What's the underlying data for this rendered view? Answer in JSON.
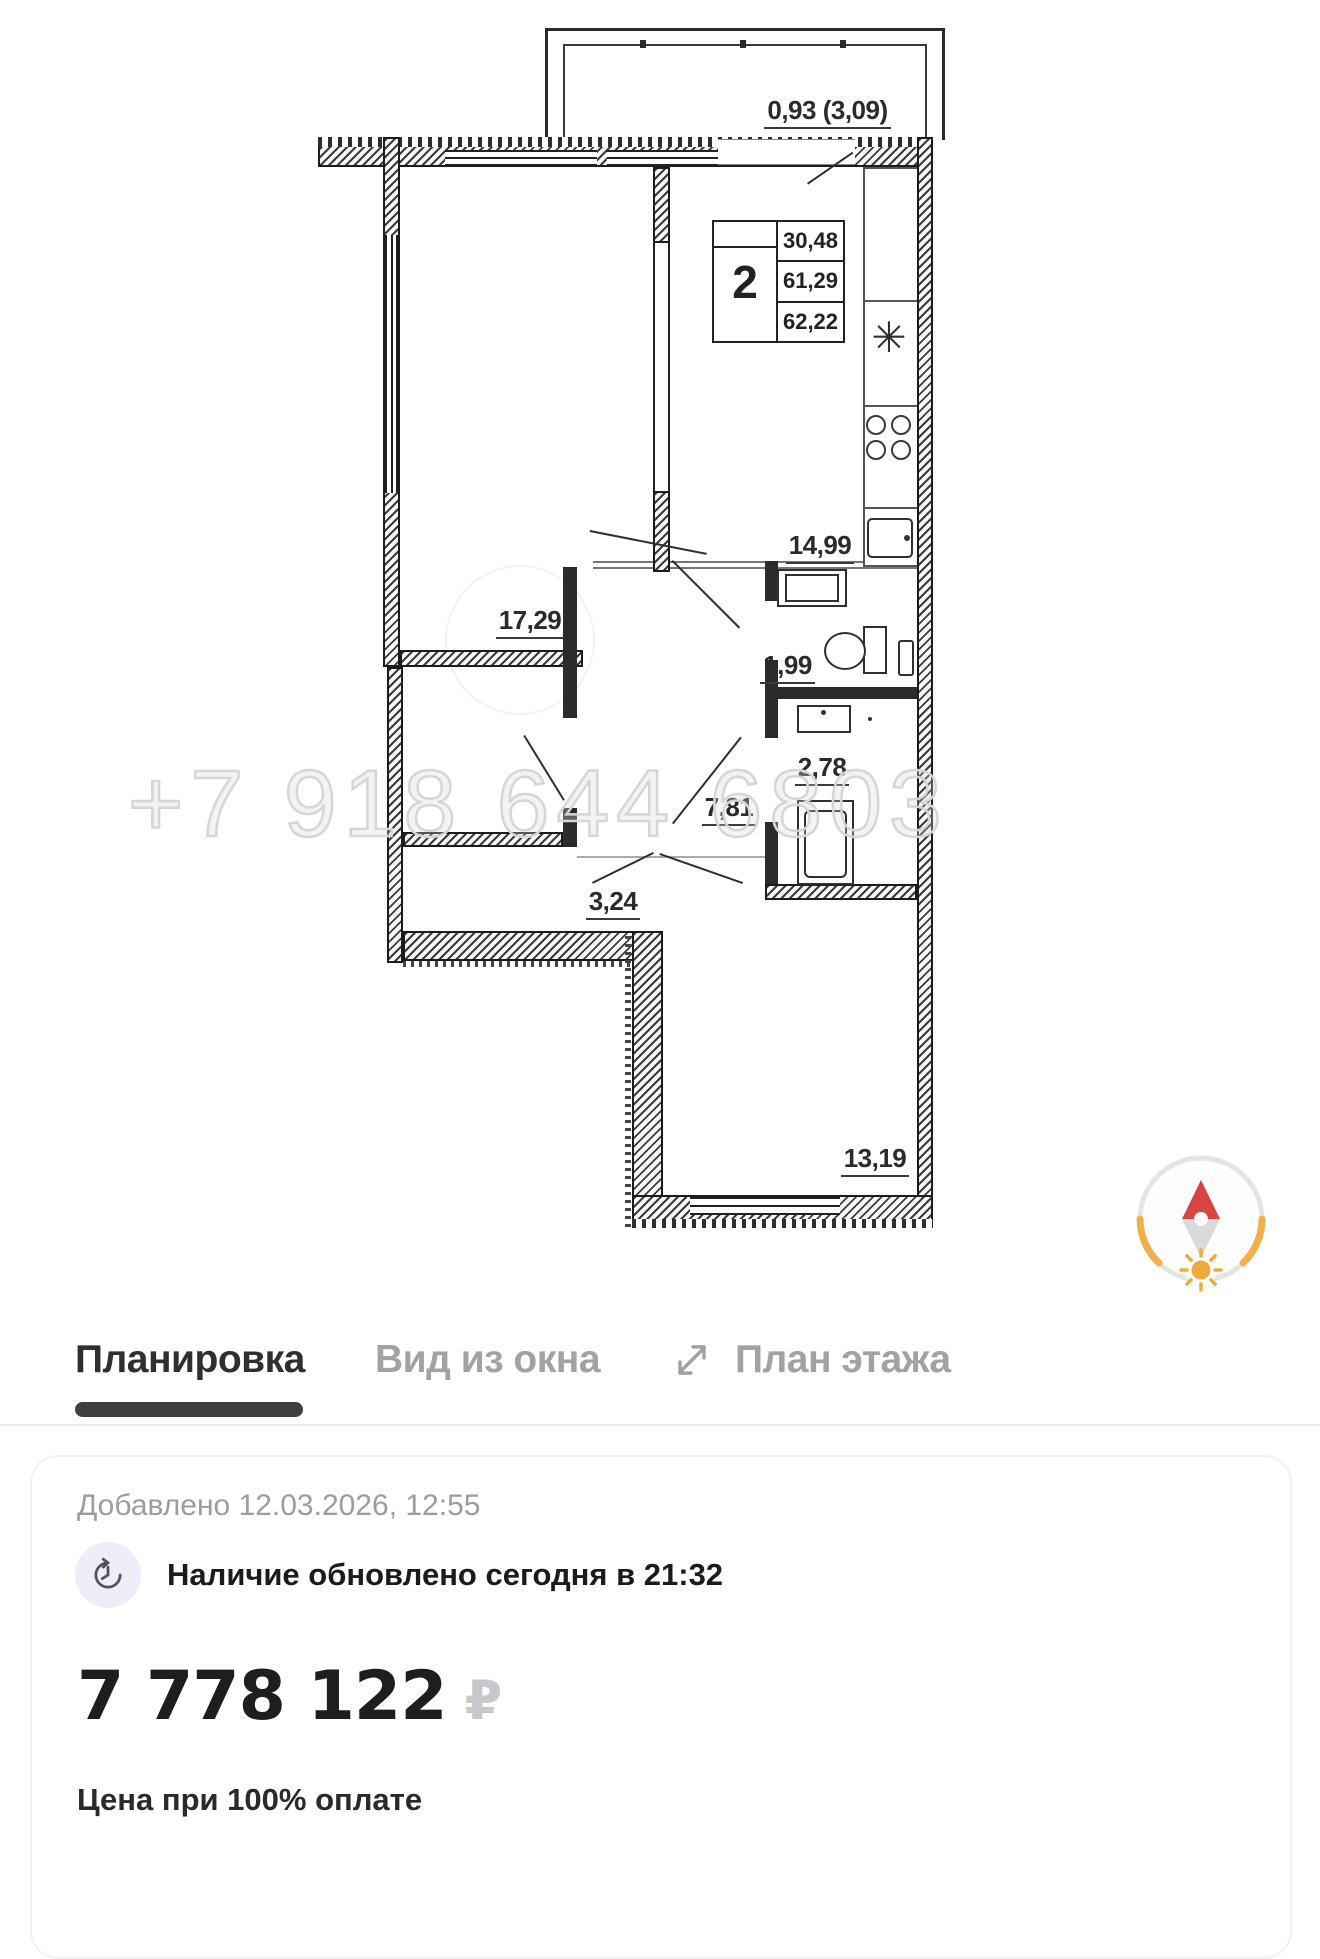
{
  "floor_plan": {
    "balcony_label": "0,93 (3,09)",
    "info_box": {
      "rooms_count": "2",
      "row1": "30,48",
      "row2": "61,29",
      "row3": "62,22"
    },
    "rooms": [
      {
        "name": "living-room",
        "area": "17,29"
      },
      {
        "name": "kitchen",
        "area": "14,99"
      },
      {
        "name": "wc",
        "area": "1,99"
      },
      {
        "name": "bathroom",
        "area": "2,78"
      },
      {
        "name": "hallway",
        "area": "7,81"
      },
      {
        "name": "corridor",
        "area": "3,24"
      },
      {
        "name": "bedroom",
        "area": "13,19"
      }
    ],
    "watermark_phone": "+7 918 644 6803",
    "compass_icon": "compass-north-icon"
  },
  "tabs": [
    {
      "label": "Планировка",
      "active": true
    },
    {
      "label": "Вид из окна",
      "active": false
    },
    {
      "label": "План этажа",
      "active": false,
      "icon": "expand-arrows-icon"
    }
  ],
  "card": {
    "added": "Добавлено 12.03.2026, 12:55",
    "availability": "Наличие обновлено сегодня в 21:32",
    "availability_icon": "clock-refresh-icon",
    "price": "7 778 122",
    "currency": "₽",
    "price_note": "Цена при 100% оплате"
  },
  "colors": {
    "active_tab": "#2f2f2f",
    "inactive_tab": "#a2a2a6",
    "price_currency": "#c8c8cc",
    "muted_text": "#9d9da1",
    "compass_north": "#d64541",
    "compass_accent": "#efaf4b",
    "icon_bg": "#efedf8"
  }
}
